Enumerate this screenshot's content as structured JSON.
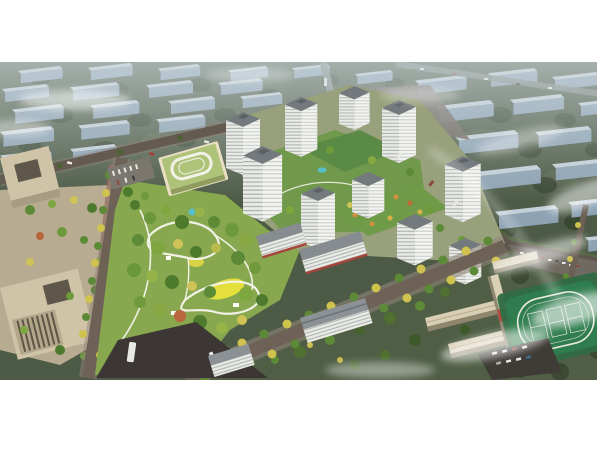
{
  "meta": {
    "type": "architectural-aerial-rendering",
    "description": "Bird's-eye rendering of a residential masterplan: white high-rise towers around landscaped courtyards, a large public park with winding white paths and a yellow lawn, a kindergarten with a green roof loop, beige office blocks at left, a school campus with running-track sports field at lower right, tree-lined boulevards, and a hazy background city of ghosted slab buildings under fog wisps.",
    "visible_text": "none"
  },
  "palette": {
    "canvas_bg": "#ffffff",
    "bg_base": "#4d5a45",
    "bg_tree": "#3a4731",
    "bg_moss": "#5c6a4e",
    "bg_slab_top": "#cfdbe6",
    "bg_slab_face": "#93a9bd",
    "bg_road": "#7d847c",
    "haze": "#d4dee3",
    "road_main": "#6e6257",
    "road_dark": "#3c3734",
    "sidewalk": "#8f837a",
    "plaza_tan": "#c3b59a",
    "plaza_red": "#9c7064",
    "office_beige": "#cfc3a8",
    "office_dark": "#5f584a",
    "tower_roof": "#74797d",
    "tower_white": "#e9ebe4",
    "tower_side": "#f3f4ef",
    "stripe": "#99a0a3",
    "awning_red": "#a5443a",
    "podium_green": "#5b8a46",
    "courtyard_green": "#70994c",
    "park_green": "#87a84e",
    "lawn_yellow": "#e4df3a",
    "path_white": "#f2f1e7",
    "pool_teal": "#58bfc7",
    "kg_roof": "#aec278",
    "kg_wall": "#eadfc4",
    "school_beige": "#d8cfb5",
    "field_green": "#2f7d4e",
    "field_apron": "#2f6a43",
    "court_red": "#b04a3c",
    "court_green": "#57934f",
    "track_white": "#e9e9e0",
    "filler_green": "#4f5e44",
    "fog": "#ffffff"
  },
  "scene": {
    "image_area": {
      "x": 0,
      "y": 62,
      "width": 597,
      "height": 318
    },
    "regions": [
      {
        "name": "background-city",
        "desc": "rows of hazy light-blue slab buildings among dark trees"
      },
      {
        "name": "residential-tower-cluster",
        "desc": "about 10 white banded towers with gray roofs"
      },
      {
        "name": "central-courtyard",
        "desc": "green podium roofs, small teal pool, roof garden with orange trees"
      },
      {
        "name": "public-park",
        "desc": "dense trees, white looping paths, bright yellow lawn, teal playground"
      },
      {
        "name": "kindergarten",
        "desc": "cream building with olive-green roof and white oval loop"
      },
      {
        "name": "office-campus",
        "desc": "two beige blocks with courtyard insets and a tree plaza"
      },
      {
        "name": "school-campus",
        "desc": "connected beige slab buildings"
      },
      {
        "name": "sports-field",
        "desc": "green pitch with white track oval and court markings"
      },
      {
        "name": "basketball-courts",
        "desc": "two red courts with green centers"
      },
      {
        "name": "roads",
        "desc": "tree-lined avenue, west boulevard, north road, east road, dark intersection"
      },
      {
        "name": "fog",
        "desc": "white cloud wisps over right and lower-right areas"
      }
    ],
    "counts": {
      "towers": 9,
      "shop_slabs": 2,
      "school_buildings": 4,
      "basketball_courts": 2
    }
  }
}
